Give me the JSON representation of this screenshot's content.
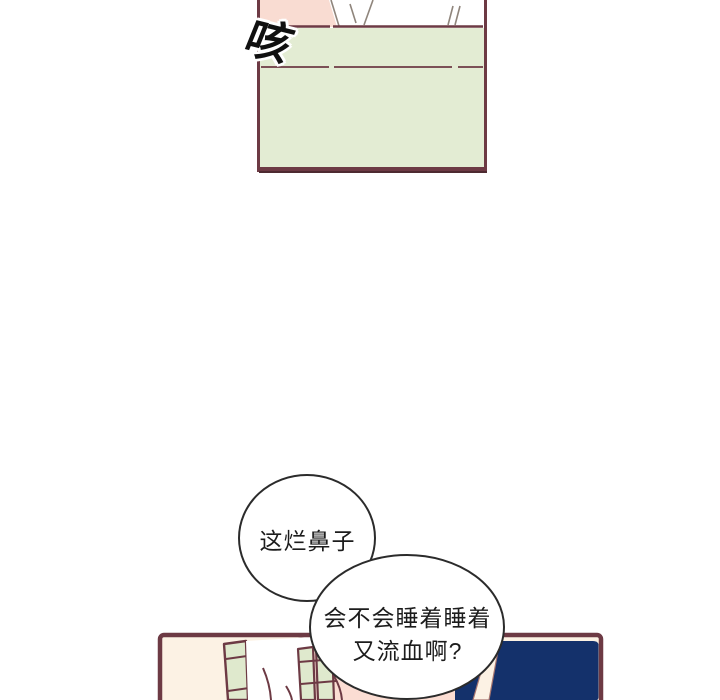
{
  "page": {
    "kind": "webtoon comic page",
    "background": "#ffffff"
  },
  "colors": {
    "panel_border": "#6d3a44",
    "panel_border_dark": "#4e2a31",
    "panel_top_pink": "#f9dcd2",
    "panel_top_green": "#e3ecd3",
    "panel_bottom_cream": "#fcf2e4",
    "slat_green": "#dfe9cd",
    "panel_bottom_pink": "#fbddd3",
    "navy": "#14316b",
    "blanket_white": "#ffffff",
    "bubble_fill": "#ffffff",
    "bubble_stroke": "#2b2b2b",
    "text": "#1c1c1c"
  },
  "panel_top": {
    "sfx": "咳"
  },
  "speech": {
    "bubble1": {
      "text": "这烂鼻子"
    },
    "bubble2": {
      "line1": "会不会睡着睡着",
      "line2": "又流血啊?"
    }
  }
}
